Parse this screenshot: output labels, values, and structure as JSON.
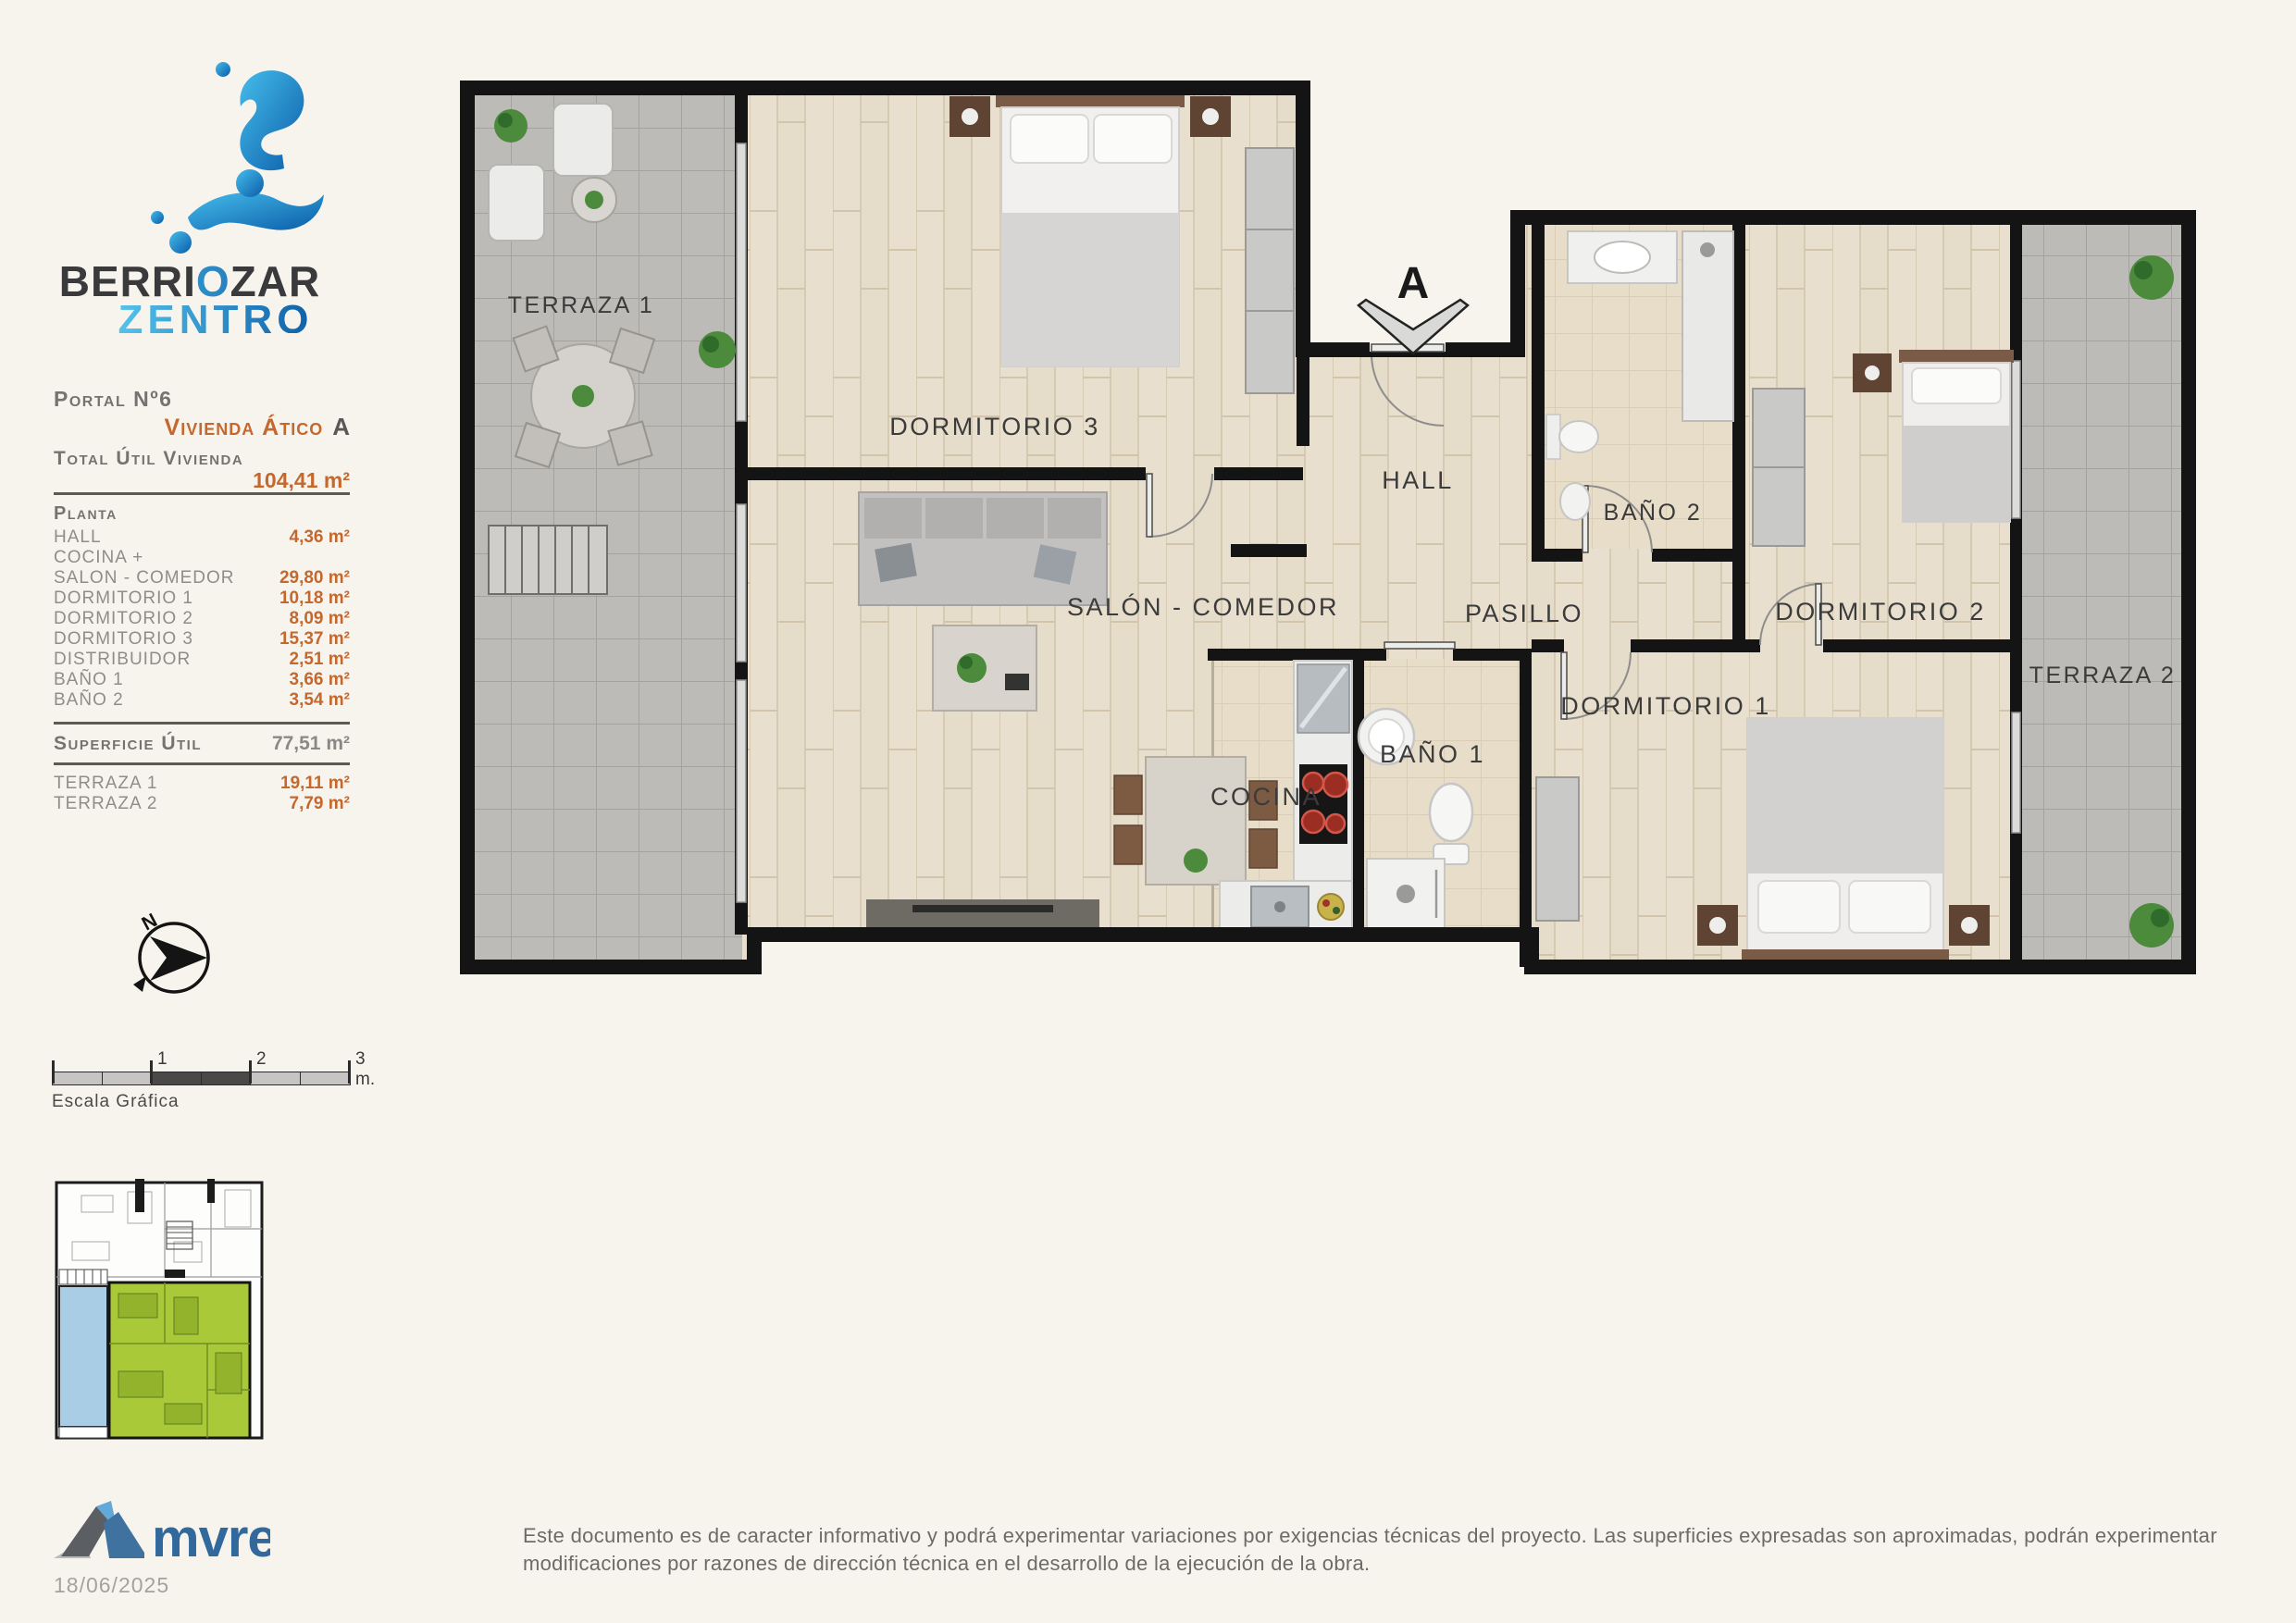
{
  "branding": {
    "line1a": "BERRI",
    "line1o": "O",
    "line1b": "ZAR",
    "line2": "ZENTRO"
  },
  "info_panel": {
    "portal": "Portal Nº6",
    "vivienda": "Vivienda Ático",
    "vivienda_letter": "A",
    "total_label": "Total Útil Vivienda",
    "total_value": "104,41 m²",
    "planta": "Planta",
    "rows": [
      {
        "label": "HALL",
        "value": "4,36 m²"
      },
      {
        "label": "COCINA +",
        "value": ""
      },
      {
        "label": "SALON - COMEDOR",
        "value": "29,80 m²"
      },
      {
        "label": "DORMITORIO 1",
        "value": "10,18 m²"
      },
      {
        "label": "DORMITORIO 2",
        "value": "8,09 m²"
      },
      {
        "label": "DORMITORIO 3",
        "value": "15,37 m²"
      },
      {
        "label": "DISTRIBUIDOR",
        "value": "2,51 m²"
      },
      {
        "label": "BAÑO 1",
        "value": "3,66 m²"
      },
      {
        "label": "BAÑO 2",
        "value": "3,54 m²"
      }
    ],
    "superficie_label": "Superficie Útil",
    "superficie_value": "77,51 m²",
    "terrazas": [
      {
        "label": "TERRAZA 1",
        "value": "19,11 m²"
      },
      {
        "label": "TERRAZA 2",
        "value": "7,79 m²"
      }
    ]
  },
  "compass": {
    "north": "N"
  },
  "scale": {
    "t1": "1",
    "t2": "2",
    "t3": "3 m.",
    "caption": "Escala Gráfica"
  },
  "plan": {
    "marker": "A",
    "rooms": {
      "terraza1": "TERRAZA 1",
      "dormitorio3": "DORMITORIO 3",
      "hall": "HALL",
      "bano2": "BAÑO 2",
      "dormitorio2": "DORMITORIO 2",
      "terraza2": "TERRAZA 2",
      "salon": "SALÓN - COMEDOR",
      "pasillo": "PASILLO",
      "dormitorio1": "DORMITORIO 1",
      "cocina": "COCINA",
      "bano1": "BAÑO 1"
    }
  },
  "footer": {
    "logo": "mvre",
    "date": "18/06/2025",
    "disclaimer": "Este documento es de caracter informativo y podrá experimentar variaciones por exigencias técnicas del proyecto. Las superficies expresadas son aproximadas, podrán experimentar modificaciones por razones de dirección técnica en el desarrollo de la ejecución de la obra."
  },
  "colors": {
    "accent_orange": "#c4682e",
    "brand_dark": "#3a393b",
    "brand_blue_light": "#53c3ec",
    "brand_blue_dark": "#0e5fa8",
    "unit_highlight_green": "#a9c938",
    "terrace_highlight_blue": "#a9cde4",
    "wall_black": "#141414",
    "wood_floor": "#e8dfce",
    "terrace_tile": "#bcbbb8"
  }
}
